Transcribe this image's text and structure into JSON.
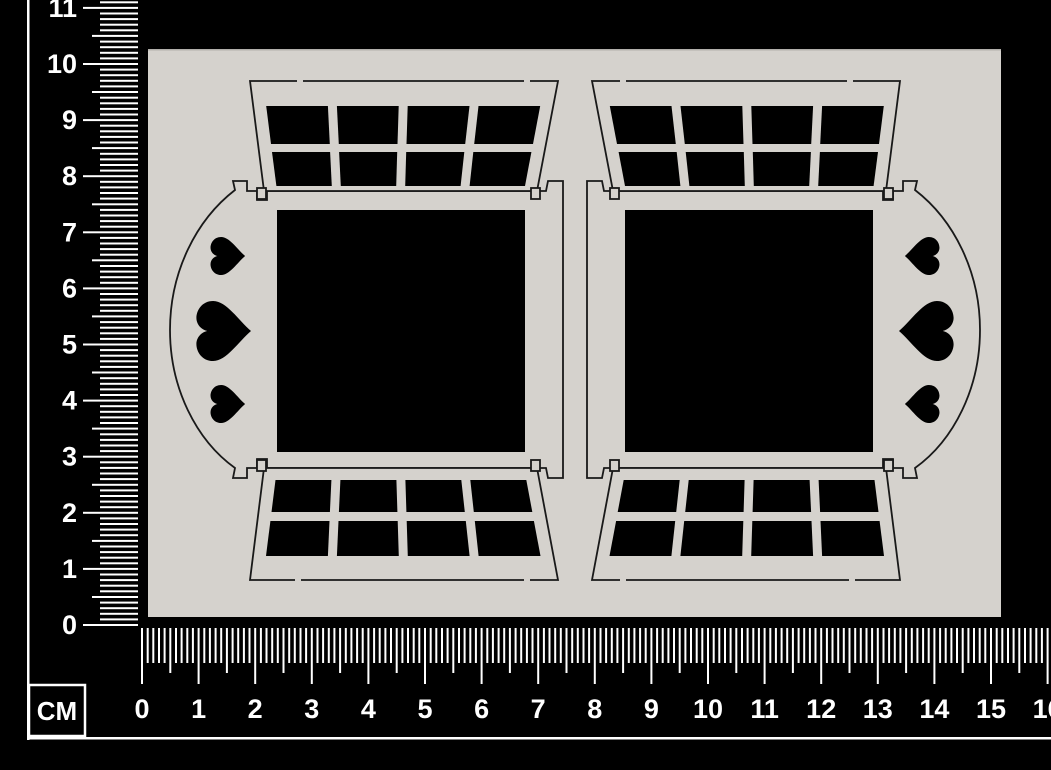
{
  "rulers": {
    "unit_label": "CM",
    "vertical_labels": [
      "0",
      "1",
      "2",
      "3",
      "4",
      "5",
      "6",
      "7",
      "8",
      "9",
      "10",
      "11"
    ],
    "horizontal_labels": [
      "0",
      "1",
      "2",
      "3",
      "4",
      "5",
      "6",
      "7",
      "8",
      "9",
      "10",
      "11",
      "12",
      "13",
      "14",
      "15",
      "16"
    ]
  },
  "colors": {
    "background": "#000000",
    "ruler": "#ffffff",
    "board": "#d5d2cd",
    "cut_line": "#191919",
    "cutout": "#000000"
  },
  "scene": {
    "description": "Two mirrored laser-cut window frame pieces with lattice panels and heart cutouts on a grey backing board, measured by centimetre rulers",
    "pieces_count": 2,
    "hearts_per_piece": 3,
    "lattice_panels_per_piece": 2,
    "panes_per_lattice_panel": 8,
    "window_opening_shape": "square"
  }
}
